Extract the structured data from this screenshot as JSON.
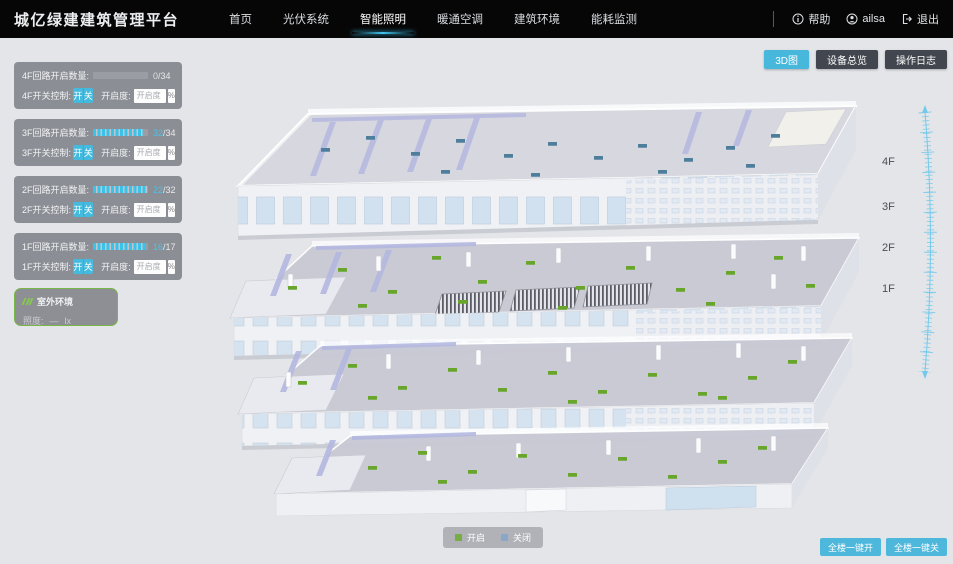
{
  "header": {
    "title": "城亿绿建建筑管理平台",
    "nav": [
      {
        "label": "首页",
        "active": false
      },
      {
        "label": "光伏系统",
        "active": false
      },
      {
        "label": "智能照明",
        "active": true
      },
      {
        "label": "暖通空调",
        "active": false
      },
      {
        "label": "建筑环境",
        "active": false
      },
      {
        "label": "能耗监测",
        "active": false
      }
    ],
    "help_label": "帮助",
    "user_name": "ailsa",
    "logout_label": "退出"
  },
  "view_buttons": [
    {
      "label": "3D图",
      "active": true
    },
    {
      "label": "设备总览",
      "active": false
    },
    {
      "label": "操作日志",
      "active": false
    }
  ],
  "floor_panels": [
    {
      "floor": "4F",
      "circuit_label": "4F回路开启数量:",
      "open": "0",
      "total": "34",
      "fill_pct": 0,
      "switch_label": "4F开关控制:",
      "on_label": "开",
      "off_label": "关",
      "openness_label": "开启度:",
      "openness_placeholder": "开启度",
      "percent_label": "%"
    },
    {
      "floor": "3F",
      "circuit_label": "3F回路开启数量:",
      "open": "32",
      "total": "34",
      "fill_pct": 93,
      "switch_label": "3F开关控制:",
      "on_label": "开",
      "off_label": "关",
      "openness_label": "开启度:",
      "openness_placeholder": "开启度",
      "percent_label": "%"
    },
    {
      "floor": "2F",
      "circuit_label": "2F回路开启数量:",
      "open": "22",
      "total": "32",
      "fill_pct": 100,
      "switch_label": "2F开关控制:",
      "on_label": "开",
      "off_label": "关",
      "openness_label": "开启度:",
      "openness_placeholder": "开启度",
      "percent_label": "%"
    },
    {
      "floor": "1F",
      "circuit_label": "1F回路开启数量:",
      "open": "16",
      "total": "17",
      "fill_pct": 94,
      "switch_label": "1F开关控制:",
      "on_label": "开",
      "off_label": "关",
      "openness_label": "开启度:",
      "openness_placeholder": "开启度",
      "percent_label": "%"
    }
  ],
  "misc": {
    "slash": "/"
  },
  "outdoor": {
    "title": "室外环境",
    "metric_label": "照度:",
    "metric_value": "—",
    "metric_unit": "lx"
  },
  "floor_labels": [
    "4F",
    "3F",
    "2F",
    "1F"
  ],
  "legend": {
    "on_label": "开启",
    "on_color": "#76ae44",
    "off_label": "关闭",
    "off_color": "#8aa6c8"
  },
  "bottom_buttons": [
    {
      "label": "全楼一键开"
    },
    {
      "label": "全楼一键关"
    }
  ],
  "colors": {
    "accent_cyan": "#47b8dc",
    "light_on_green": "#67a62a",
    "light_off_blue": "#4d7e9b",
    "header_bg": "#060607",
    "canvas_bg": "#e3e5e9"
  }
}
